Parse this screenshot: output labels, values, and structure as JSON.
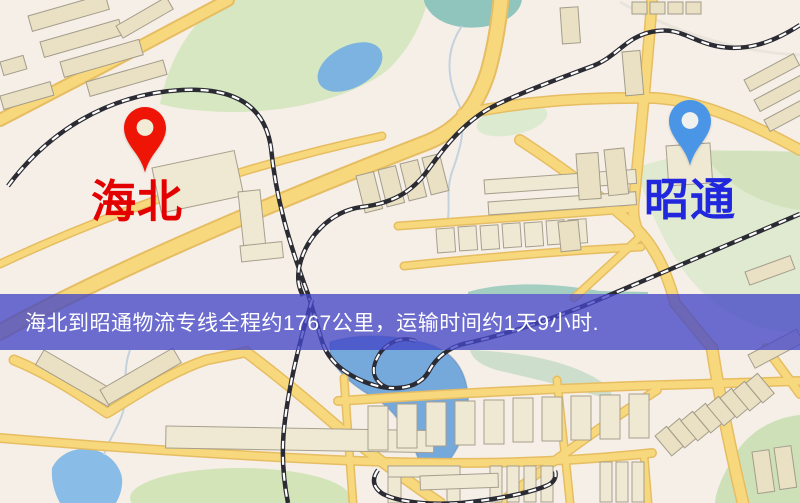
{
  "map": {
    "origin": {
      "name": "海北",
      "marker": "red-pin",
      "marker_color": "#ee1506",
      "marker_hole": "#f2ebd6",
      "label_color": "#e30000"
    },
    "destination": {
      "name": "昭通",
      "marker": "blue-pin",
      "marker_color": "#4a95e6",
      "marker_hole": "#eef1ee",
      "label_color": "#2127dd"
    }
  },
  "banner": {
    "text": "海北到昭通物流专线全程约1767公里，运输时间约1天9小时.",
    "background": "rgba(68,70,198,0.78)",
    "text_color": "#ffffff"
  },
  "route": {
    "from": "海北",
    "to": "昭通",
    "distance_km": "1767",
    "duration": "1天9小时"
  }
}
